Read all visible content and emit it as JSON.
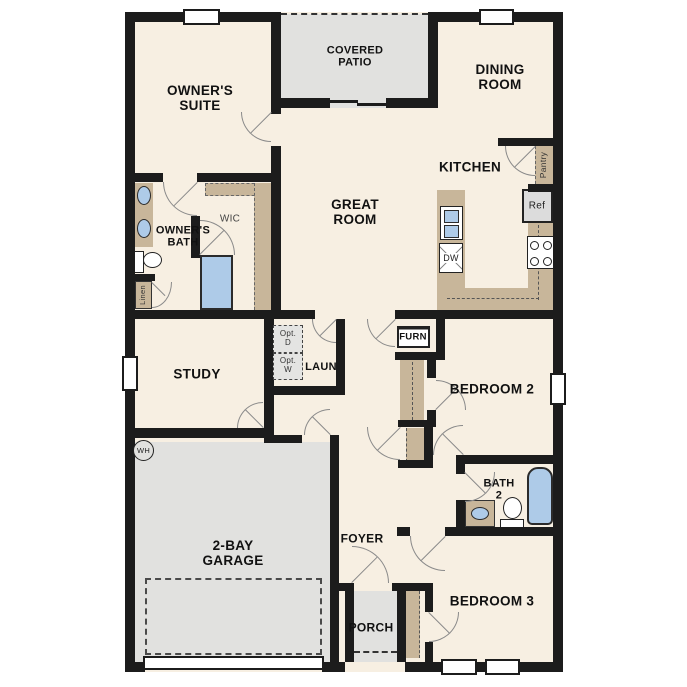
{
  "plan_title": "Single-story floor plan",
  "colors": {
    "floor": "#f7efe2",
    "wall": "#1c1c1c",
    "counter": "#c8b69a",
    "fixture": "#aecbe8",
    "zone": "#e1e1df",
    "option_box": "#e4e4e2"
  },
  "labels": {
    "owners_suite": [
      "OWNER'S",
      "SUITE"
    ],
    "covered_patio": [
      "COVERED",
      "PATIO"
    ],
    "dining_room": [
      "DINING",
      "ROOM"
    ],
    "great_room": [
      "GREAT",
      "ROOM"
    ],
    "kitchen": "KITCHEN",
    "owners_bath": [
      "OWNER'S",
      "BATH"
    ],
    "wic": "WIC",
    "study": "STUDY",
    "laundry": "LAUN",
    "bedroom2": "BEDROOM 2",
    "bath2": [
      "BATH",
      "2"
    ],
    "garage": [
      "2-BAY",
      "GARAGE"
    ],
    "foyer": "FOYER",
    "porch": "PORCH",
    "bedroom3": "BEDROOM 3",
    "pantry": "Pantry",
    "ref": "Ref",
    "dw": "DW",
    "furn": "FURN",
    "linen": "Linen",
    "wh": "WH",
    "opt_d": [
      "Opt.",
      "D"
    ],
    "opt_w": [
      "Opt.",
      "W"
    ]
  }
}
